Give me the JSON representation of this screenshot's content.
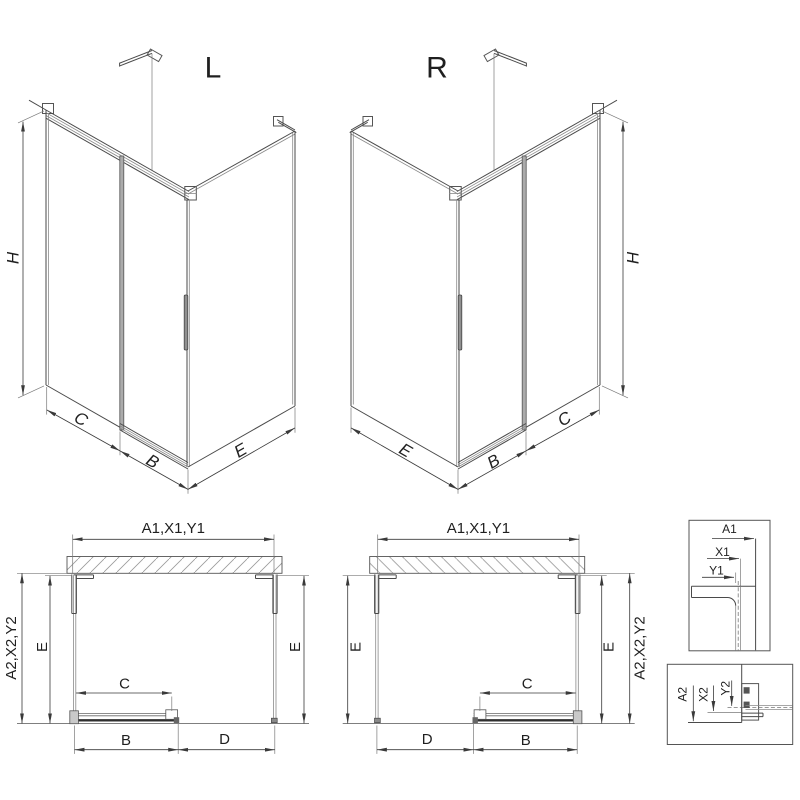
{
  "page": {
    "background": "#ffffff",
    "line_color": "#4a4a4a",
    "door_edge_color": "#2f2f2f",
    "text_color": "#1f1f1f"
  },
  "iso_views": {
    "left": {
      "variant_label": "L",
      "height_dim": "H",
      "fixed_dim": "C",
      "door_dim": "B",
      "side_dim": "E"
    },
    "right": {
      "variant_label": "R",
      "height_dim": "H",
      "fixed_dim": "C",
      "door_dim": "B",
      "side_dim": "E"
    }
  },
  "plan_views": {
    "left": {
      "width_dim": "A1,X1,Y1",
      "depth_outer_dim": "A2,X2,Y2",
      "depth_left_dim": "E",
      "depth_right_dim": "E",
      "fixed_dim": "C",
      "door_dim": "B",
      "opening_dim": "D"
    },
    "right": {
      "width_dim": "A1,X1,Y1",
      "depth_outer_dim": "A2,X2,Y2",
      "depth_left_dim": "E",
      "depth_right_dim": "E",
      "fixed_dim": "C",
      "door_dim": "B",
      "opening_dim": "D"
    }
  },
  "details": {
    "wall_profile_top": {
      "dims": [
        "A1",
        "X1",
        "Y1"
      ]
    },
    "wall_profile_side": {
      "dims": [
        "A2",
        "X2",
        "Y2"
      ]
    }
  }
}
